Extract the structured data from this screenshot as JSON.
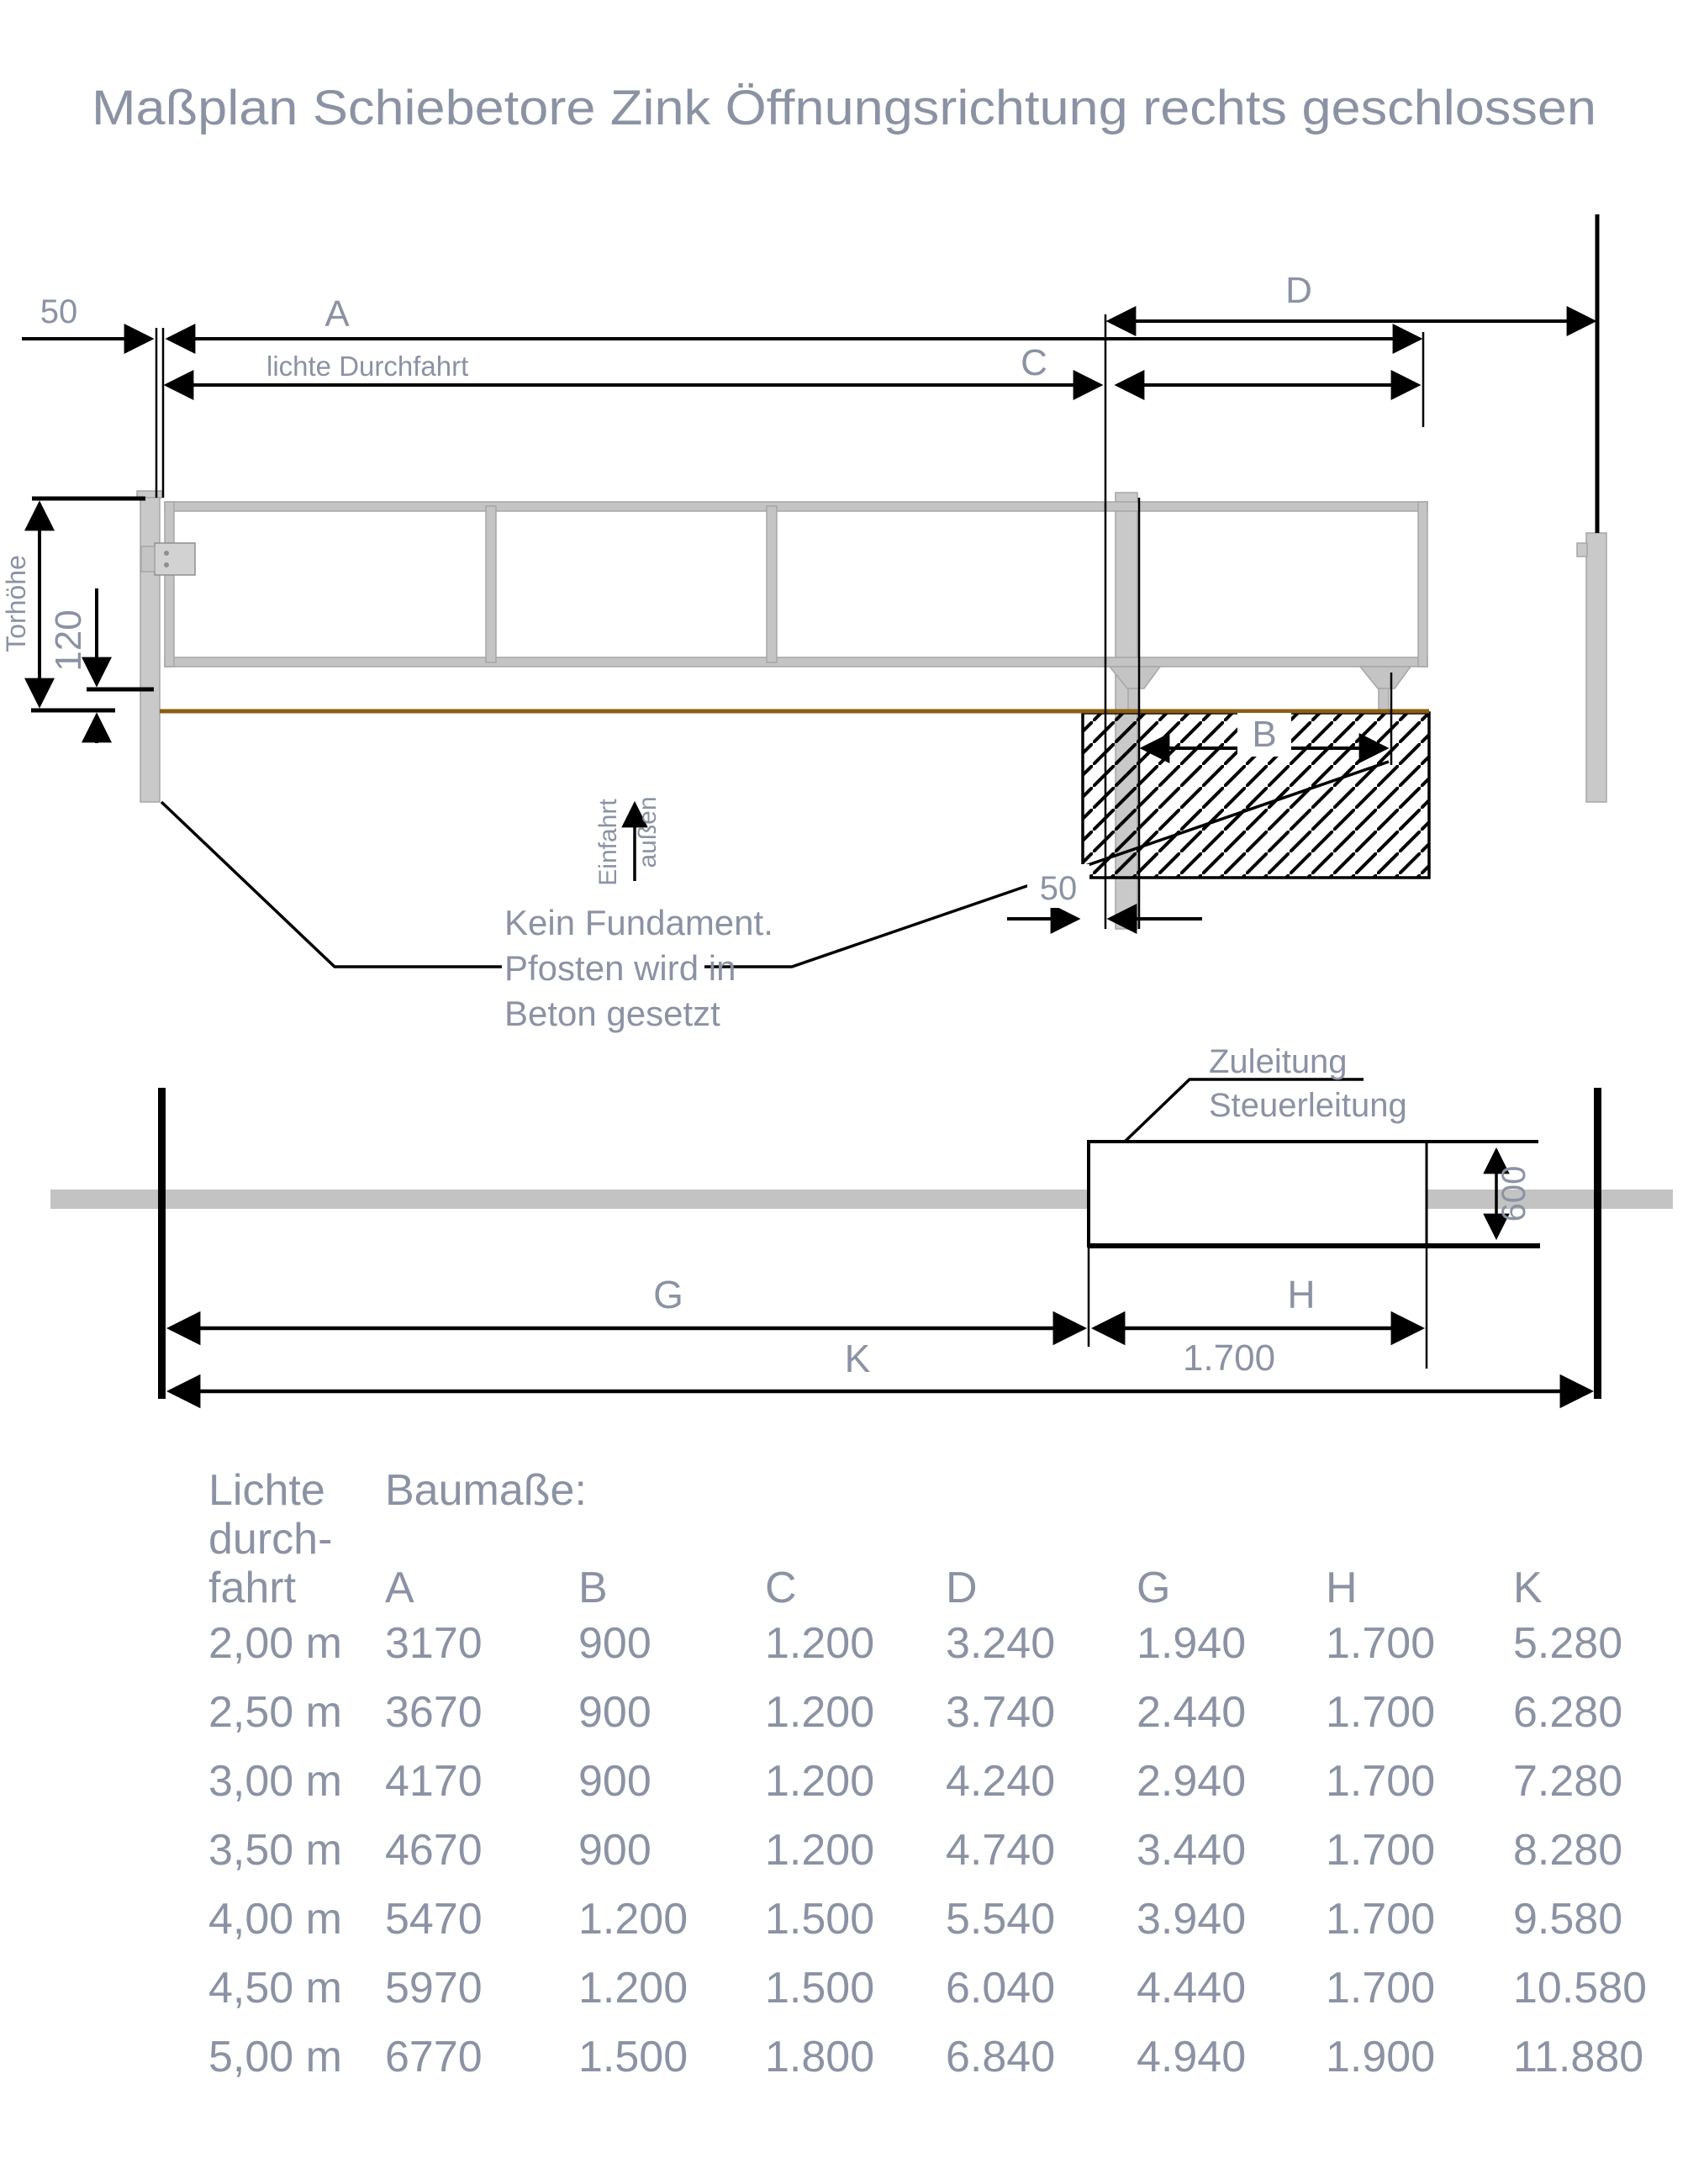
{
  "title": "Maßplan Schiebetore Zink Öffnungsrichtung rechts geschlossen",
  "colors": {
    "label": "#8B92A3",
    "ground": "#8B5E12",
    "metal": "#C9C9C9",
    "line": "#000000"
  },
  "top_view": {
    "dim_a": "A",
    "dim_b": "B",
    "dim_c": "C",
    "dim_d": "D",
    "gap_50": "50",
    "foundation_gap_50": "50",
    "gap_120": "120",
    "clear_passage": "lichte Durchfahrt",
    "gate_height": "Torhöhe",
    "entry": "Einfahrt",
    "outside": "außen",
    "note_line1": "Kein Fundament.",
    "note_line2": "Pfosten wird in",
    "note_line3": "Beton gesetzt"
  },
  "bottom_view": {
    "supply": "Zuleitung",
    "control": "Steuerleitung",
    "depth_600": "600",
    "dim_g": "G",
    "dim_h": "H",
    "dim_k": "K",
    "h_value": "1.700"
  },
  "table": {
    "row_header": [
      "Lichte",
      "durch-",
      "fahrt"
    ],
    "group_header": "Baumaße:",
    "columns": [
      "A",
      "B",
      "C",
      "D",
      "G",
      "H",
      "K"
    ],
    "rows": [
      [
        "2,00 m",
        "3170",
        "900",
        "1.200",
        "3.240",
        "1.940",
        "1.700",
        "5.280"
      ],
      [
        "2,50 m",
        "3670",
        "900",
        "1.200",
        "3.740",
        "2.440",
        "1.700",
        "6.280"
      ],
      [
        "3,00 m",
        "4170",
        "900",
        "1.200",
        "4.240",
        "2.940",
        "1.700",
        "7.280"
      ],
      [
        "3,50 m",
        "4670",
        "900",
        "1.200",
        "4.740",
        "3.440",
        "1.700",
        "8.280"
      ],
      [
        "4,00 m",
        "5470",
        "1.200",
        "1.500",
        "5.540",
        "3.940",
        "1.700",
        "9.580"
      ],
      [
        "4,50 m",
        "5970",
        "1.200",
        "1.500",
        "6.040",
        "4.440",
        "1.700",
        "10.580"
      ],
      [
        "5,00 m",
        "6770",
        "1.500",
        "1.800",
        "6.840",
        "4.940",
        "1.900",
        "11.880"
      ]
    ]
  }
}
